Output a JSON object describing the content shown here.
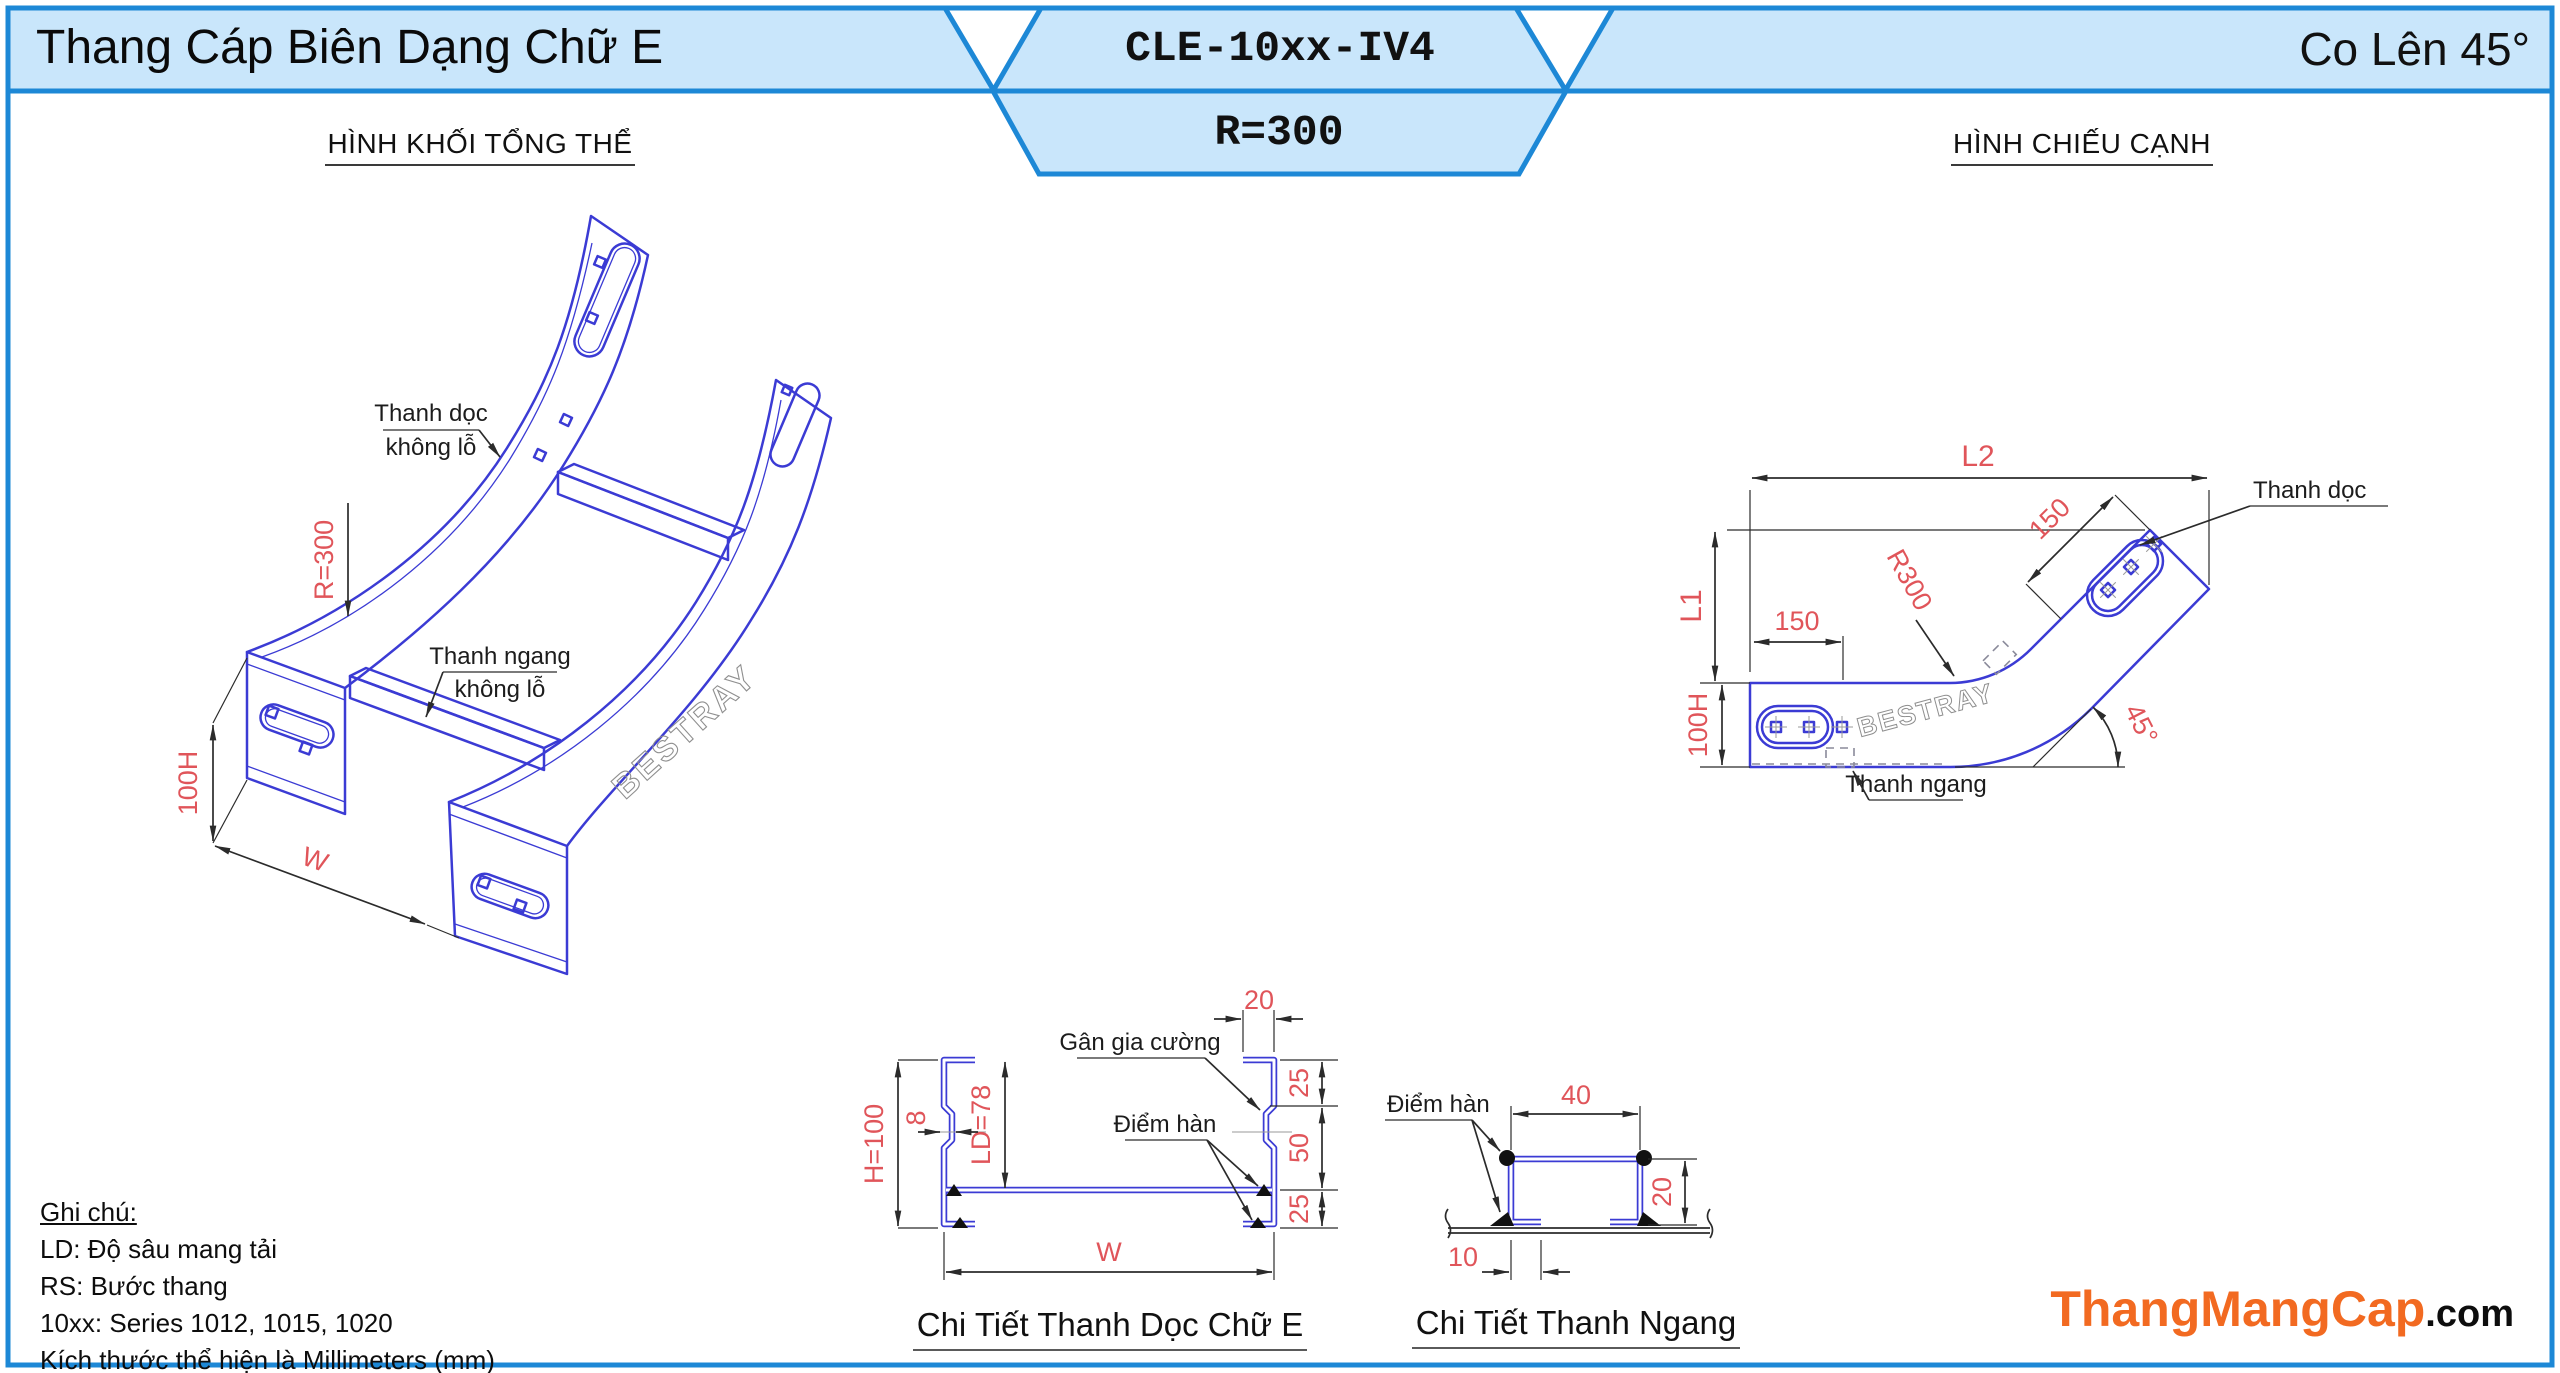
{
  "header": {
    "left_title": "Thang Cáp Biên Dạng Chữ E",
    "model_code": "CLE-10xx-IV4",
    "radius_code": "R=300",
    "right_title": "Co Lên 45°"
  },
  "section_titles": {
    "iso": "HÌNH KHỐI TỔNG THỂ",
    "side": "HÌNH CHIẾU CẠNH"
  },
  "iso": {
    "rail_label_1": "Thanh dọc",
    "rail_label_2": "không lỗ",
    "rung_label_1": "Thanh ngang",
    "rung_label_2": "không lỗ",
    "dim_radius": "R=300",
    "dim_height": "100H",
    "dim_width": "W",
    "watermark": "BESTRAY"
  },
  "side": {
    "dim_l2": "L2",
    "dim_l1": "L1",
    "dim_150_left": "150",
    "dim_150_diag": "150",
    "dim_radius": "R300",
    "dim_height": "100H",
    "dim_angle": "45°",
    "rail_label": "Thanh dọc",
    "rung_label": "Thanh ngang",
    "watermark": "BESTRAY"
  },
  "e_detail": {
    "title": "Chi Tiết Thanh Dọc Chữ E",
    "rib_label": "Gân gia cường",
    "weld_label": "Điểm hàn",
    "dim_h": "H=100",
    "dim_ld": "LD=78",
    "dim_web": "8",
    "dim_lip": "20",
    "dim_25_top": "25",
    "dim_50": "50",
    "dim_25_bottom": "25",
    "dim_w": "W"
  },
  "rung_detail": {
    "title": "Chi Tiết Thanh Ngang",
    "weld_label": "Điểm hàn",
    "dim_40": "40",
    "dim_20": "20",
    "dim_10": "10"
  },
  "notes": {
    "heading": "Ghi chú:",
    "lines": [
      "LD: Độ sâu mang tải",
      "RS: Bước thang",
      "10xx: Series 1012, 1015, 1020",
      "Kích thước thể hiện là Millimeters (mm)"
    ]
  },
  "brand": {
    "name": "ThangMangCap",
    "tld": ".com"
  },
  "colors": {
    "line_blue": "#3b3bd4",
    "dim_red": "#e0555a",
    "header_fill": "#c9e6fb",
    "header_stroke": "#1d88d6",
    "brand_orange": "#f26a21",
    "watermark_gray": "#8f8f8f"
  }
}
